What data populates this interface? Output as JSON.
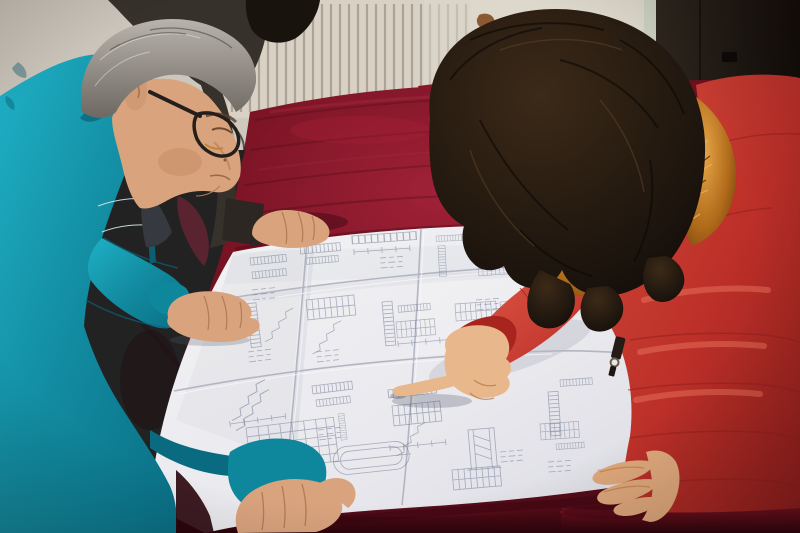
{
  "scene": {
    "description": "Two workers lean over a large folded engineering blueprint spread on a red velvet-covered table: a gray-haired man in a teal work jacket and dark-rimmed glasses studies the drawing while a woman in a red parka with an orange fur-trimmed hood points at a detail; a third colleague in a dark jacket rests a hand on the sheet. Behind them are a beige wall, a cream radiator with vertical fins, a metal-frame chair with a red seat and a dark door.",
    "people": {
      "man_left": {
        "label": "engineer in teal work jacket",
        "features": "gray hair, dark-rimmed glasses, leaning over drawing"
      },
      "person_behind": {
        "label": "colleague in dark jacket, partially visible, hand resting on blueprint"
      },
      "woman_right": {
        "label": "woman in red fur-trimmed parka pointing at the drawing"
      }
    },
    "objects": {
      "blueprint": {
        "label": "large folded technical drawing",
        "content": "dense illegible structural linework: stair sections, rebar ladders, dimension lines, schedule tables, an oval detail"
      },
      "table": {
        "label": "table covered in deep red velvet"
      },
      "radiator": {
        "label": "cream wall radiator with vertical fins"
      },
      "chair": {
        "label": "metal tube chair with red seat behind table"
      },
      "door": {
        "label": "dark door panel at right"
      },
      "wall": {
        "label": "beige wall with small rust stain"
      }
    }
  },
  "colors": {
    "wall_left": "#c7c1b7",
    "wall_right": "#ded9cd",
    "radiator_body": "#d8d1c4",
    "radiator_fin": "#7e766b",
    "door": "#1c1510",
    "door_frame": "#ccd0c0",
    "rust_stain": "#7c4318",
    "chair_metal": "#b9b7b3",
    "chair_seat": "#8e1422",
    "table_red": "#7c1222",
    "table_red_bright": "#a32036",
    "table_red_dark": "#30040c",
    "paper": "#e9e9ee",
    "paper_crease": "#b3b6c2",
    "drawing_ink": "#6f7890",
    "jacket_teal": "#149db4",
    "jacket_teal_dark": "#0a6b80",
    "inner_shirt": "#363a40",
    "colleague_jacket": "#37312b",
    "colleague_hair": "#19130e",
    "maroon_garment": "#5a2330",
    "man_hair_gray": "#8f8a82",
    "skin": "#d9a37e",
    "skin_woman": "#e8b78c",
    "skin_woman_shadow": "#dfa87c",
    "woman_face_shadow": "#c98f6a",
    "coat_red": "#c03028",
    "coat_red_bright": "#d84b3c",
    "coat_red_dark": "#8c1d1b",
    "fur_orange": "#c27e2c",
    "woman_hair": "#1f150d",
    "glasses_frame": "#241f1a"
  }
}
